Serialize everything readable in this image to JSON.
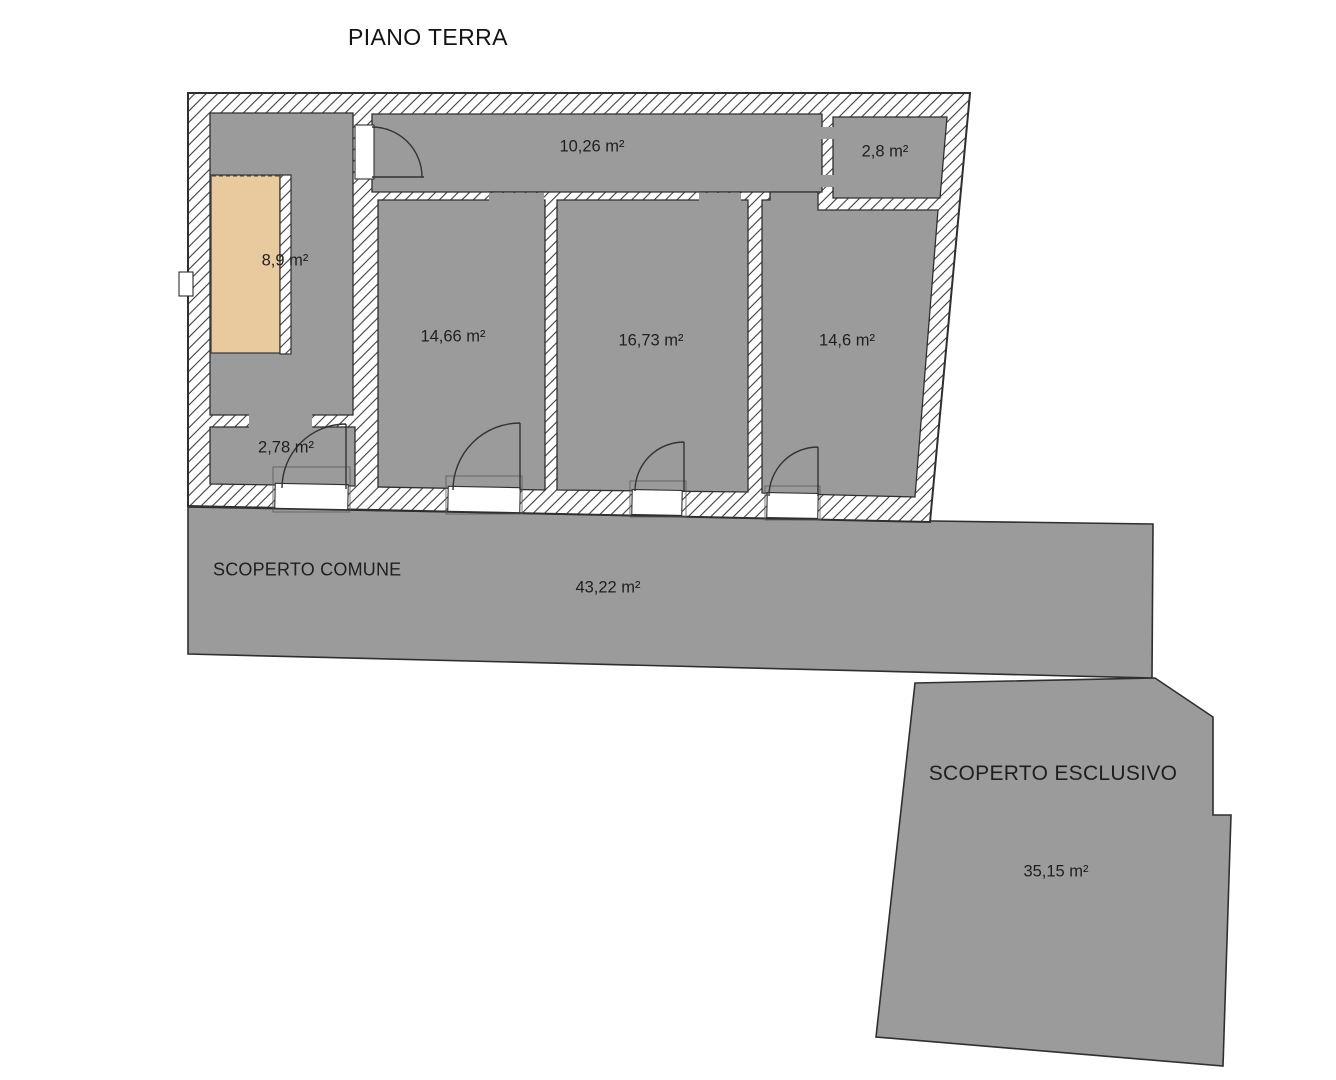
{
  "title": "PIANO TERRA",
  "colors": {
    "background": "#ffffff",
    "room_fill": "#9b9b9b",
    "stair_fill": "#e9c99e",
    "outline": "#2f2f2f"
  },
  "rooms": [
    {
      "id": "corridoio",
      "area_label": "10,26 m²"
    },
    {
      "id": "ripostiglio",
      "area_label": "2,8 m²"
    },
    {
      "id": "vano-scala",
      "area_label": "8,9 m²"
    },
    {
      "id": "locale-1",
      "area_label": "14,66 m²"
    },
    {
      "id": "locale-2",
      "area_label": "16,73 m²"
    },
    {
      "id": "locale-3",
      "area_label": "14,6 m²"
    },
    {
      "id": "ingresso",
      "area_label": "2,78 m²"
    }
  ],
  "outdoor_areas": [
    {
      "id": "scoperto-comune",
      "name": "SCOPERTO COMUNE",
      "area_label": "43,22 m²"
    },
    {
      "id": "scoperto-esclusivo",
      "name": "SCOPERTO ESCLUSIVO",
      "area_label": "35,15 m²"
    }
  ]
}
